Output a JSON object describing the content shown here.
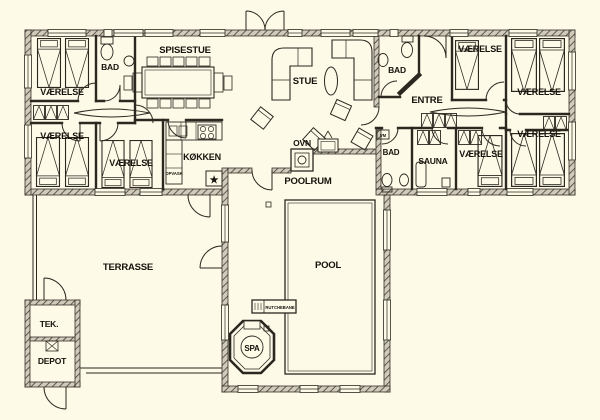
{
  "title": "Sommerhus plantegning",
  "colors": {
    "background": "#fdfae8",
    "line": "#2b2820",
    "wall_fill": "#cfcaba"
  },
  "rooms": {
    "vaerelse_tl": "VÆRELSE",
    "bad_left": "BAD",
    "spisestue": "SPISESTUE",
    "stue": "STUE",
    "bad_right": "BAD",
    "entre": "ENTRE",
    "vaerelse_tr1": "VÆRELSE",
    "vaerelse_tr2": "VÆRELSE",
    "vaerelse_ll1": "VÆRELSE",
    "vaerelse_ll2": "VÆRELSE",
    "koekken": "KØKKEN",
    "ovn": "OVN",
    "poolrum": "POOLRUM",
    "bad_lower": "BAD",
    "sauna": "SAUNA",
    "vaerelse_lr1": "VÆRELSE",
    "vaerelse_lr2": "VÆRELSE",
    "terrasse": "TERRASSE",
    "pool": "POOL",
    "spa": "SPA",
    "tek": "TEK.",
    "depot": "DEPOT"
  },
  "annotations": {
    "opvask": "OPVASK",
    "vm": "VM",
    "rutchebane": "RUTCHEBANE",
    "star_marker": "★"
  }
}
